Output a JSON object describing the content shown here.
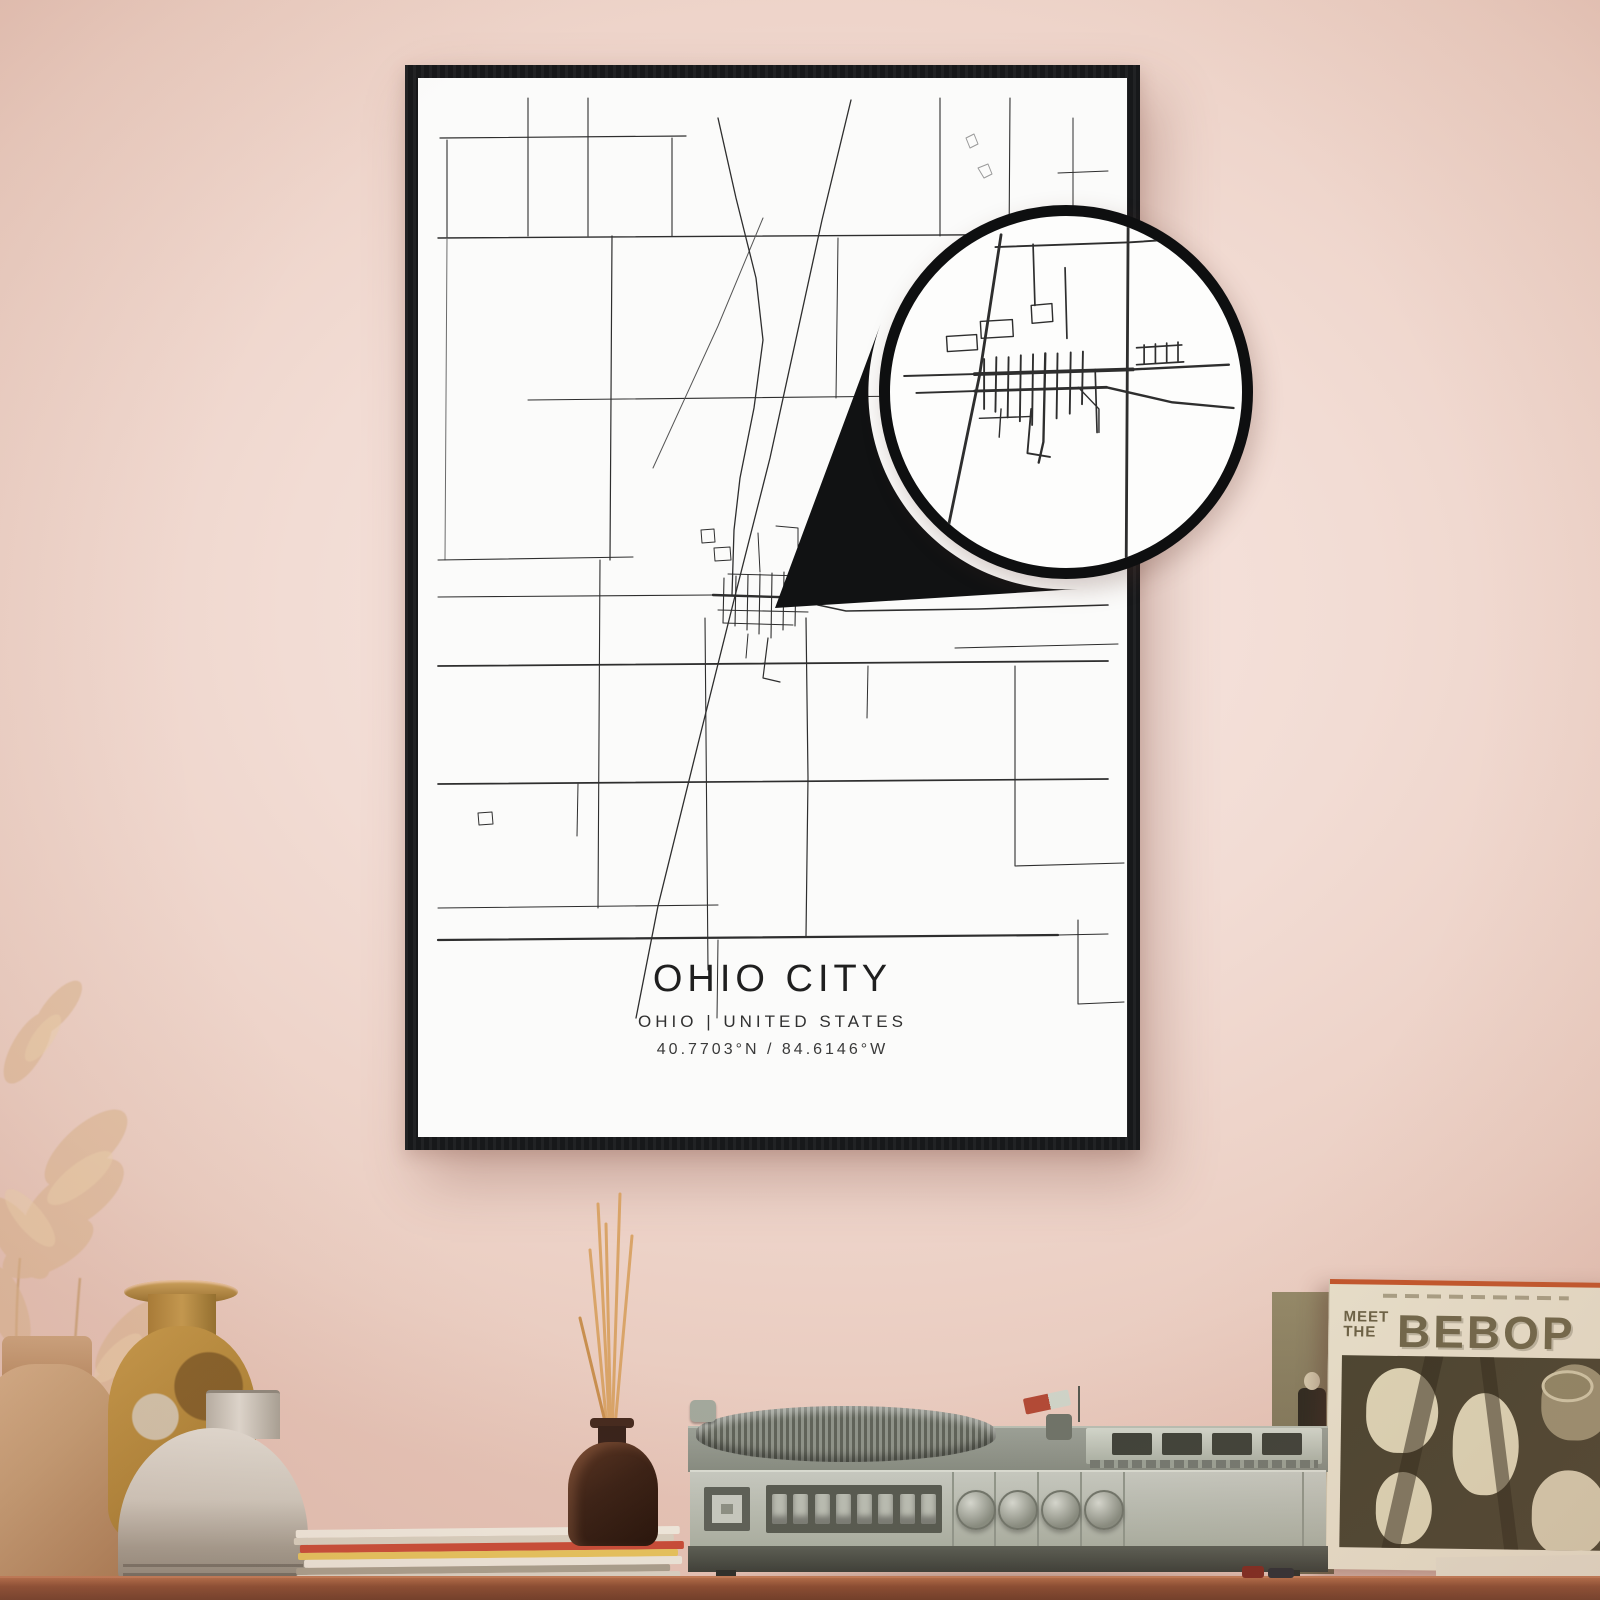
{
  "poster": {
    "title": "OHIO CITY",
    "subtitle": "OHIO | UNITED STATES",
    "coordinates": "40.7703°N / 84.6146°W"
  },
  "album": {
    "meet": "MEET",
    "the": "THE",
    "title": "BEBOP"
  },
  "palette": {
    "wall": "#f2dcd4",
    "frame": "#17181a",
    "poster_bg": "#fbfbfa",
    "road_dark": "#2e2e2e",
    "accent_orange": "#c2562c",
    "album_text": "#70674a",
    "table_brown": "#8a4c31",
    "vase_tan": "#c49d74",
    "vase_mustard": "#b08537",
    "vase_gray": "#cfc9be",
    "reed": "#d9a468",
    "player_gray": "#b9bdb2"
  },
  "map": {
    "roads": [
      {
        "w": 1.2,
        "pts": [
          [
            22,
            60
          ],
          [
            268,
            58
          ]
        ]
      },
      {
        "w": 1.4,
        "pts": [
          [
            20,
            160
          ],
          [
            690,
            156
          ]
        ]
      },
      {
        "w": 1.1,
        "pts": [
          [
            110,
            20
          ],
          [
            110,
            158
          ]
        ]
      },
      {
        "w": 1.1,
        "pts": [
          [
            29,
            62
          ],
          [
            29,
            160
          ]
        ]
      },
      {
        "w": 1.0,
        "c": "#6b6b6b",
        "pts": [
          [
            29,
            160
          ],
          [
            27,
            482
          ]
        ]
      },
      {
        "w": 1.1,
        "pts": [
          [
            170,
            20
          ],
          [
            170,
            158
          ]
        ]
      },
      {
        "w": 1.2,
        "pts": [
          [
            194,
            158
          ],
          [
            192,
            482
          ]
        ]
      },
      {
        "w": 1.1,
        "pts": [
          [
            254,
            60
          ],
          [
            254,
            158
          ]
        ]
      },
      {
        "w": 1.1,
        "pts": [
          [
            110,
            322
          ],
          [
            690,
            316
          ]
        ]
      },
      {
        "w": 1.0,
        "pts": [
          [
            420,
            160
          ],
          [
            418,
            320
          ]
        ]
      },
      {
        "w": 1.1,
        "pts": [
          [
            522,
            20
          ],
          [
            522,
            158
          ]
        ]
      },
      {
        "w": 1.1,
        "pts": [
          [
            592,
            20
          ],
          [
            590,
            322
          ]
        ]
      },
      {
        "w": 1.0,
        "pts": [
          [
            655,
            40
          ],
          [
            655,
            158
          ]
        ]
      },
      {
        "w": 1.0,
        "pts": [
          [
            640,
            95
          ],
          [
            690,
            93
          ]
        ]
      },
      {
        "w": 1.0,
        "c": "#9a9a9a",
        "pts": [
          [
            548,
            60
          ],
          [
            556,
            56
          ],
          [
            560,
            66
          ],
          [
            552,
            70
          ],
          [
            548,
            60
          ]
        ]
      },
      {
        "w": 1.0,
        "c": "#9a9a9a",
        "pts": [
          [
            560,
            90
          ],
          [
            570,
            86
          ],
          [
            574,
            96
          ],
          [
            566,
            100
          ],
          [
            560,
            90
          ]
        ]
      },
      {
        "w": 1.1,
        "pts": [
          [
            20,
            482
          ],
          [
            215,
            479
          ]
        ]
      },
      {
        "w": 1.8,
        "pts": [
          [
            20,
            588
          ],
          [
            690,
            583
          ]
        ]
      },
      {
        "w": 1.1,
        "pts": [
          [
            20,
            519
          ],
          [
            295,
            517
          ]
        ]
      },
      {
        "w": 2.4,
        "pts": [
          [
            295,
            517
          ],
          [
            392,
            520
          ]
        ]
      },
      {
        "w": 1.6,
        "pts": [
          [
            392,
            520
          ],
          [
            400,
            527
          ],
          [
            428,
            533
          ],
          [
            560,
            531
          ],
          [
            690,
            527
          ]
        ]
      },
      {
        "w": 1.1,
        "pts": [
          [
            537,
            570
          ],
          [
            700,
            566
          ]
        ]
      },
      {
        "w": 1.3,
        "pts": [
          [
            433,
            22
          ],
          [
            404,
            142
          ],
          [
            352,
            380
          ],
          [
            316,
            522
          ],
          [
            281,
            662
          ],
          [
            240,
            828
          ],
          [
            218,
            940
          ]
        ]
      },
      {
        "w": 1.0,
        "c": "#555555",
        "pts": [
          [
            345,
            140
          ],
          [
            300,
            248
          ],
          [
            235,
            390
          ]
        ]
      },
      {
        "w": 1.3,
        "pts": [
          [
            300,
            40
          ],
          [
            318,
            120
          ],
          [
            338,
            200
          ],
          [
            345,
            262
          ],
          [
            336,
            330
          ],
          [
            322,
            400
          ],
          [
            316,
            452
          ],
          [
            314,
            517
          ]
        ]
      },
      {
        "w": 1.1,
        "pts": [
          [
            306,
            500
          ],
          [
            305,
            545
          ]
        ]
      },
      {
        "w": 1.1,
        "pts": [
          [
            318,
            498
          ],
          [
            317,
            548
          ]
        ]
      },
      {
        "w": 1.1,
        "pts": [
          [
            330,
            497
          ],
          [
            329,
            552
          ]
        ]
      },
      {
        "w": 1.1,
        "pts": [
          [
            342,
            496
          ],
          [
            341,
            556
          ]
        ]
      },
      {
        "w": 1.1,
        "pts": [
          [
            354,
            495
          ],
          [
            353,
            560
          ]
        ]
      },
      {
        "w": 1.1,
        "pts": [
          [
            366,
            494
          ],
          [
            365,
            552
          ]
        ]
      },
      {
        "w": 1.1,
        "pts": [
          [
            378,
            494
          ],
          [
            377,
            548
          ]
        ]
      },
      {
        "w": 1.1,
        "pts": [
          [
            300,
            532
          ],
          [
            390,
            534
          ]
        ]
      },
      {
        "w": 1.0,
        "pts": [
          [
            305,
            545
          ],
          [
            375,
            547
          ]
        ]
      },
      {
        "w": 1.0,
        "pts": [
          [
            310,
            496
          ],
          [
            385,
            498
          ]
        ]
      },
      {
        "w": 1.2,
        "pts": [
          [
            350,
            560
          ],
          [
            345,
            600
          ],
          [
            362,
            604
          ]
        ]
      },
      {
        "w": 1.0,
        "pts": [
          [
            330,
            556
          ],
          [
            328,
            580
          ]
        ]
      },
      {
        "w": 1.0,
        "pts": [
          [
            340,
            455
          ],
          [
            342,
            494
          ]
        ]
      },
      {
        "w": 1.0,
        "pts": [
          [
            358,
            448
          ],
          [
            380,
            450
          ],
          [
            380,
            470
          ]
        ]
      },
      {
        "w": 1.0,
        "pts": [
          [
            296,
            470
          ],
          [
            312,
            469
          ],
          [
            313,
            482
          ],
          [
            297,
            483
          ],
          [
            296,
            470
          ]
        ]
      },
      {
        "w": 1.0,
        "pts": [
          [
            283,
            452
          ],
          [
            296,
            451
          ],
          [
            297,
            464
          ],
          [
            284,
            465
          ],
          [
            283,
            452
          ]
        ]
      },
      {
        "w": 1.2,
        "pts": [
          [
            388,
            540
          ],
          [
            390,
            700
          ],
          [
            388,
            858
          ]
        ]
      },
      {
        "w": 1.1,
        "pts": [
          [
            182,
            482
          ],
          [
            180,
            830
          ]
        ]
      },
      {
        "w": 1.1,
        "pts": [
          [
            287,
            540
          ],
          [
            290,
            892
          ]
        ]
      },
      {
        "w": 1.7,
        "pts": [
          [
            20,
            706
          ],
          [
            690,
            701
          ]
        ]
      },
      {
        "w": 1.1,
        "pts": [
          [
            20,
            830
          ],
          [
            300,
            827
          ]
        ]
      },
      {
        "w": 2.2,
        "pts": [
          [
            20,
            862
          ],
          [
            640,
            857
          ]
        ]
      },
      {
        "w": 1.1,
        "pts": [
          [
            640,
            857
          ],
          [
            690,
            856
          ]
        ]
      },
      {
        "w": 1.1,
        "pts": [
          [
            597,
            588
          ],
          [
            597,
            788
          ],
          [
            706,
            785
          ]
        ]
      },
      {
        "w": 1.1,
        "pts": [
          [
            660,
            842
          ],
          [
            660,
            926
          ],
          [
            706,
            924
          ]
        ]
      },
      {
        "w": 1.0,
        "pts": [
          [
            300,
            862
          ],
          [
            299,
            940
          ]
        ]
      },
      {
        "w": 1.0,
        "pts": [
          [
            60,
            735
          ],
          [
            74,
            734
          ],
          [
            75,
            746
          ],
          [
            61,
            747
          ],
          [
            60,
            735
          ]
        ]
      },
      {
        "w": 1.0,
        "pts": [
          [
            160,
            706
          ],
          [
            159,
            758
          ]
        ]
      },
      {
        "w": 1.0,
        "pts": [
          [
            450,
            588
          ],
          [
            449,
            640
          ]
        ]
      }
    ],
    "inset_roads": [
      {
        "w": 3.0,
        "pts": [
          [
            118,
            20
          ],
          [
            95,
            170
          ],
          [
            62,
            330
          ]
        ]
      },
      {
        "w": 3.0,
        "pts": [
          [
            253,
            12
          ],
          [
            251,
            362
          ]
        ]
      },
      {
        "w": 2.0,
        "pts": [
          [
            112,
            33
          ],
          [
            255,
            28
          ],
          [
            345,
            22
          ]
        ]
      },
      {
        "w": 2.0,
        "pts": [
          [
            15,
            170
          ],
          [
            90,
            168
          ]
        ]
      },
      {
        "w": 4.0,
        "pts": [
          [
            90,
            168
          ],
          [
            258,
            163
          ]
        ]
      },
      {
        "w": 2.5,
        "pts": [
          [
            258,
            163
          ],
          [
            360,
            158
          ]
        ]
      },
      {
        "w": 2.0,
        "pts": [
          [
            28,
            188
          ],
          [
            90,
            186
          ]
        ]
      },
      {
        "w": 3.0,
        "pts": [
          [
            90,
            186
          ],
          [
            230,
            182
          ]
        ]
      },
      {
        "w": 2.5,
        "pts": [
          [
            230,
            182
          ],
          [
            300,
            198
          ],
          [
            365,
            204
          ]
        ]
      },
      {
        "w": 2.0,
        "pts": [
          [
            100,
            152
          ],
          [
            100,
            205
          ]
        ]
      },
      {
        "w": 2.0,
        "pts": [
          [
            113,
            150
          ],
          [
            112,
            208
          ]
        ]
      },
      {
        "w": 2.0,
        "pts": [
          [
            126,
            150
          ],
          [
            125,
            214
          ]
        ]
      },
      {
        "w": 2.0,
        "pts": [
          [
            139,
            148
          ],
          [
            138,
            218
          ]
        ]
      },
      {
        "w": 2.0,
        "pts": [
          [
            152,
            147
          ],
          [
            151,
            222
          ]
        ]
      },
      {
        "w": 2.5,
        "pts": [
          [
            165,
            146
          ],
          [
            163,
            240
          ],
          [
            158,
            262
          ]
        ]
      },
      {
        "w": 2.0,
        "pts": [
          [
            178,
            146
          ],
          [
            177,
            215
          ]
        ]
      },
      {
        "w": 2.0,
        "pts": [
          [
            192,
            145
          ],
          [
            191,
            210
          ]
        ]
      },
      {
        "w": 2.0,
        "pts": [
          [
            205,
            144
          ],
          [
            204,
            200
          ]
        ]
      },
      {
        "w": 1.8,
        "pts": [
          [
            262,
            140
          ],
          [
            310,
            137
          ]
        ]
      },
      {
        "w": 1.8,
        "pts": [
          [
            262,
            158
          ],
          [
            312,
            155
          ]
        ]
      },
      {
        "w": 1.8,
        "pts": [
          [
            270,
            137
          ],
          [
            270,
            157
          ]
        ]
      },
      {
        "w": 1.8,
        "pts": [
          [
            282,
            136
          ],
          [
            282,
            156
          ]
        ]
      },
      {
        "w": 1.8,
        "pts": [
          [
            294,
            135
          ],
          [
            294,
            155
          ]
        ]
      },
      {
        "w": 1.8,
        "pts": [
          [
            306,
            134
          ],
          [
            306,
            154
          ]
        ]
      },
      {
        "w": 1.8,
        "pts": [
          [
            152,
            30
          ],
          [
            154,
            95
          ]
        ]
      },
      {
        "w": 1.8,
        "pts": [
          [
            186,
            55
          ],
          [
            188,
            130
          ]
        ]
      },
      {
        "w": 1.5,
        "pts": [
          [
            150,
            95
          ],
          [
            172,
            93
          ],
          [
            173,
            112
          ],
          [
            151,
            114
          ],
          [
            150,
            95
          ]
        ]
      },
      {
        "w": 1.5,
        "pts": [
          [
            60,
            128
          ],
          [
            92,
            126
          ],
          [
            93,
            142
          ],
          [
            61,
            144
          ],
          [
            60,
            128
          ]
        ]
      },
      {
        "w": 1.5,
        "pts": [
          [
            96,
            112
          ],
          [
            130,
            110
          ],
          [
            131,
            128
          ],
          [
            97,
            130
          ],
          [
            96,
            112
          ]
        ]
      },
      {
        "w": 2.0,
        "pts": [
          [
            150,
            205
          ],
          [
            146,
            252
          ],
          [
            170,
            256
          ]
        ]
      },
      {
        "w": 1.5,
        "pts": [
          [
            118,
            205
          ],
          [
            116,
            235
          ]
        ]
      },
      {
        "w": 1.5,
        "pts": [
          [
            95,
            215
          ],
          [
            150,
            213
          ]
        ]
      },
      {
        "w": 1.8,
        "pts": [
          [
            218,
            163
          ],
          [
            220,
            230
          ]
        ]
      },
      {
        "w": 1.5,
        "pts": [
          [
            200,
            182
          ],
          [
            222,
            205
          ],
          [
            222,
            230
          ]
        ]
      }
    ]
  }
}
